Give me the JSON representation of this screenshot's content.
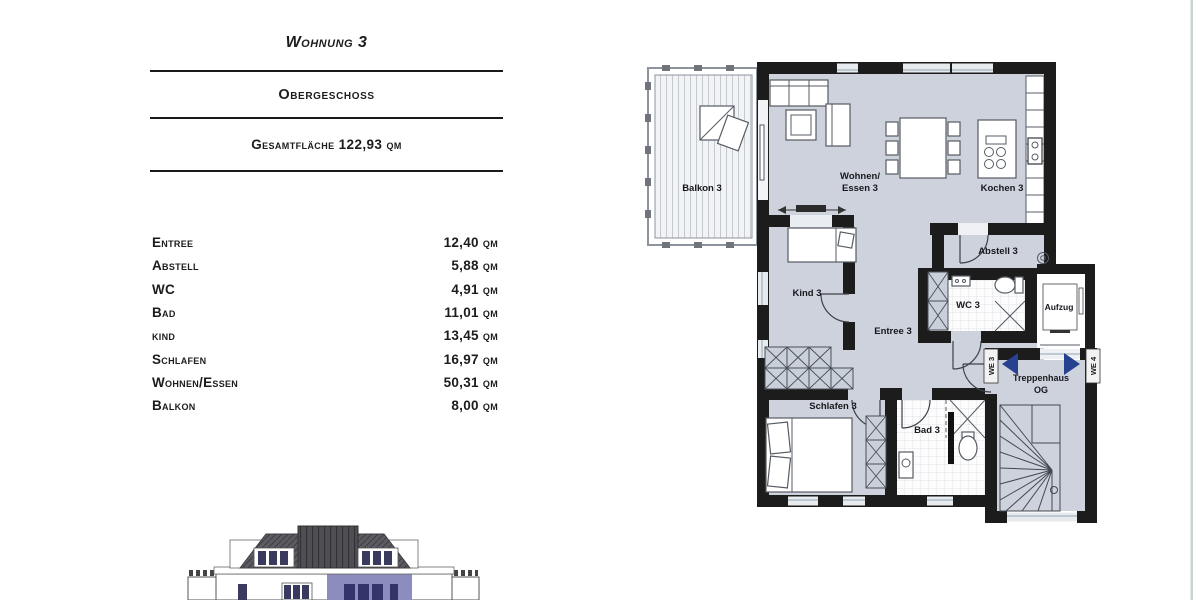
{
  "header": {
    "title": "Wohnung 3",
    "subtitle": "Obergeschoss",
    "total": "Gesamtfläche 122,93 qm"
  },
  "room_list": {
    "rows": [
      {
        "name": "Entree",
        "area": "12,40 qm"
      },
      {
        "name": "Abstell",
        "area": "5,88 qm"
      },
      {
        "name": "WC",
        "area": "4,91 qm"
      },
      {
        "name": "Bad",
        "area": "11,01 qm"
      },
      {
        "name": "kind",
        "area": "13,45 qm"
      },
      {
        "name": "Schlafen",
        "area": "16,97 qm"
      },
      {
        "name": "Wohnen/Essen",
        "area": "50,31 qm"
      },
      {
        "name": "Balkon",
        "area": "8,00 qm"
      }
    ]
  },
  "plan": {
    "labels": {
      "balkon": "Balkon 3",
      "wohnen1": "Wohnen/",
      "wohnen2": "Essen 3",
      "kochen": "Kochen 3",
      "abstell": "Abstell 3",
      "wc": "WC 3",
      "aufzug": "Aufzug",
      "entree": "Entree 3",
      "kind": "Kind 3",
      "schlafen": "Schlafen 3",
      "bad": "Bad 3",
      "trepp1": "Treppenhaus",
      "trepp2": "OG",
      "we3": "WE 3",
      "we4": "WE 4"
    },
    "colors": {
      "floor": "#cdd2dc",
      "wall": "#1c1c1c",
      "arrow": "#26418f",
      "accent": "#8c8cbe"
    }
  }
}
